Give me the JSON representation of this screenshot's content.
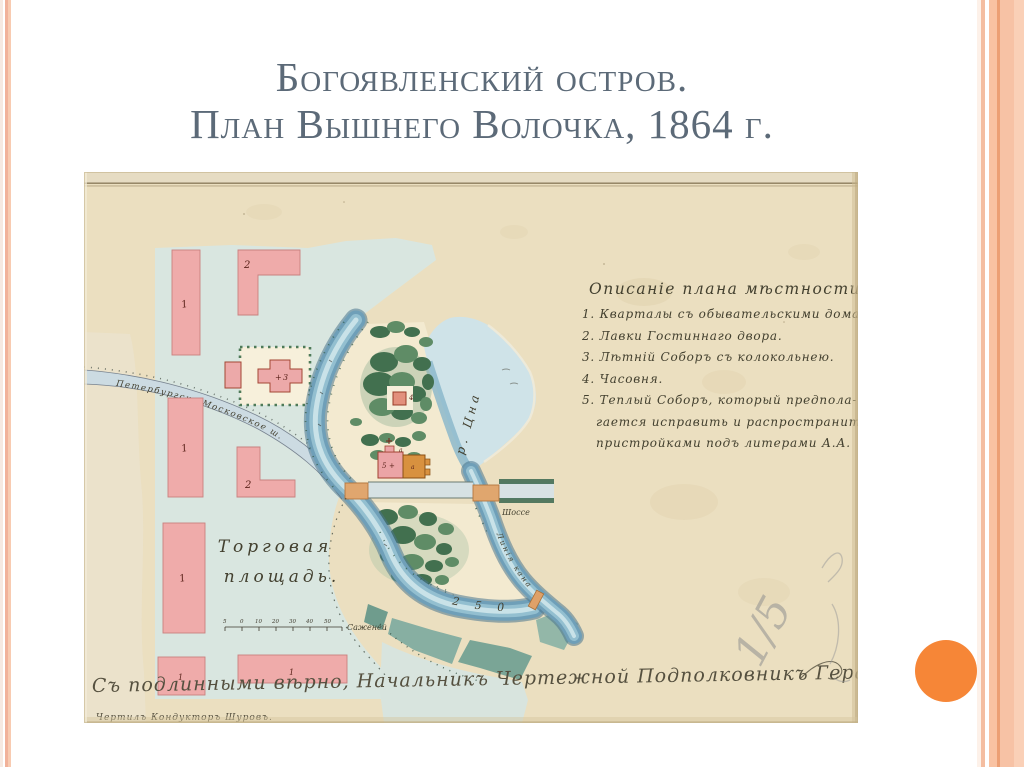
{
  "slide": {
    "title_line1": "Богоявленский остров.",
    "title_line2": "План Вышнего Волочка, 1864 г.",
    "title_color": "#5c6a78",
    "accent_color": "#f68637",
    "stripe_colors": [
      "#f1b29a",
      "#f8cbb1",
      "#f9c2a2",
      "#ec9f74"
    ]
  },
  "map": {
    "palette": {
      "paper": "#ebdfc0",
      "square": "#d9e6e0",
      "water": "#6f9fb8",
      "blocks_pink": "#efabaa",
      "garden_green": "#42704f",
      "bridge": "#e0a66e",
      "ink": "#43402f"
    },
    "legend": {
      "title": "Описаніе плана мѣстности.",
      "items": [
        "1. Кварталы съ обывательскими домами.",
        "2. Лавки Гостиннаго двора.",
        "3. Лѣтній Соборъ съ колокольнею.",
        "4. Часовня.",
        "5. Теплый Соборъ, который предпола-",
        "гается исправить и распространить",
        "пристройками подъ литерами А.А."
      ]
    },
    "labels": {
      "square_line1": "Торговая",
      "square_line2": "площадь.",
      "road_diagonal": "Петербургско-Московское ш.",
      "road_east": "Шоссе",
      "river": "р. Цна",
      "canal": "Линія канала",
      "distance": "250",
      "scale_unit": "Саженей",
      "scale_numbers": [
        "5",
        "0",
        "10",
        "20",
        "30",
        "40",
        "50"
      ],
      "block_residential": "1",
      "block_shops": "2",
      "summer_cathedral": "3",
      "chapel": "4",
      "warm_cathedral": "5",
      "annex_letter": "а",
      "pencil_fraction": "1/5"
    },
    "signature": {
      "line1": "Съ подлинными вѣрно, Начальникъ Чертежной Подполковникъ Герасимовъ",
      "line2": "Чертилъ Кондукторъ Шуровъ."
    }
  }
}
